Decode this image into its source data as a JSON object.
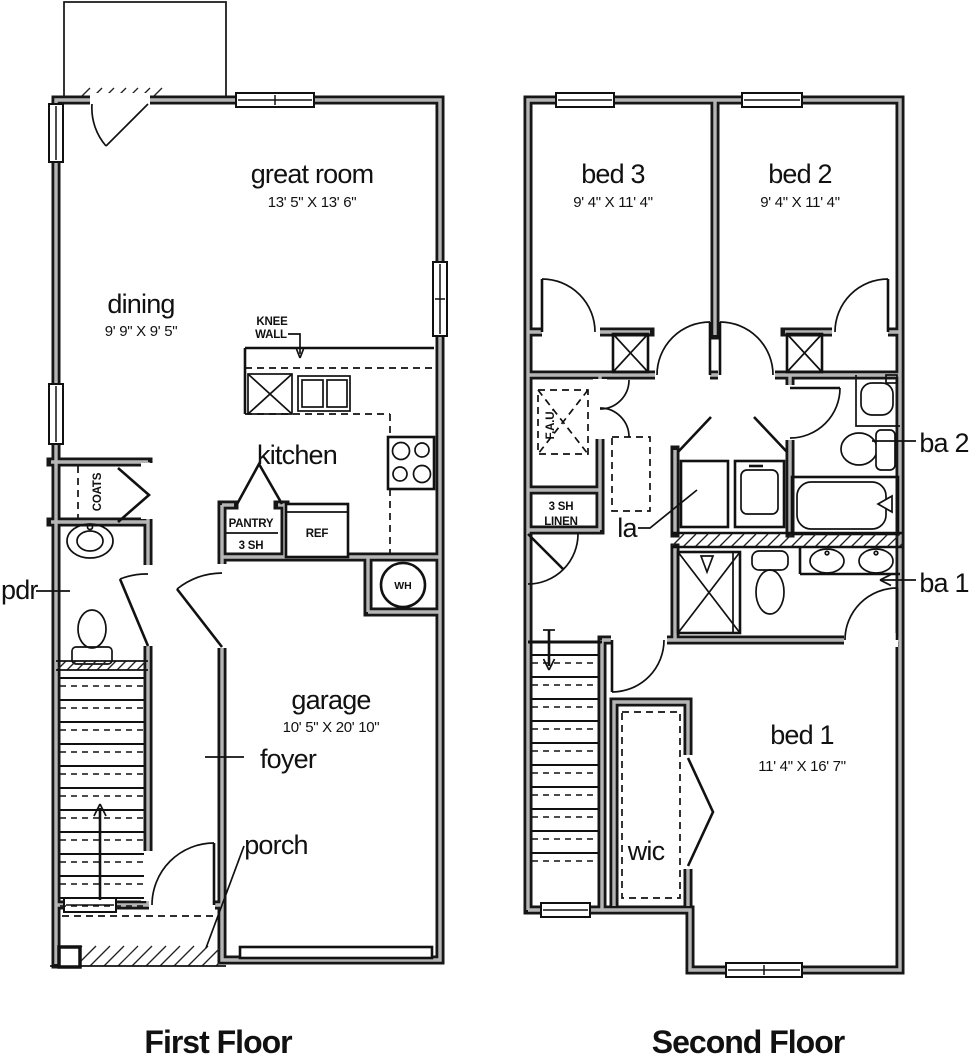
{
  "titles": {
    "first": "First Floor",
    "second": "Second Floor"
  },
  "first_floor": {
    "great_room": {
      "name": "great room",
      "dims": "13' 5\" X 13' 6\""
    },
    "dining": {
      "name": "dining",
      "dims": "9' 9\" X 9' 5\""
    },
    "kitchen": {
      "name": "kitchen"
    },
    "garage": {
      "name": "garage",
      "dims": "10' 5\" X 20' 10\""
    },
    "foyer": {
      "name": "foyer"
    },
    "porch": {
      "name": "porch"
    },
    "pdr": {
      "name": "pdr"
    },
    "coats": {
      "name": "COATS"
    },
    "pantry": {
      "name": "PANTRY",
      "sub": "3 SH"
    },
    "ref": {
      "name": "REF"
    },
    "wh": {
      "name": "WH"
    },
    "knee_wall": {
      "line1": "KNEE",
      "line2": "WALL"
    }
  },
  "second_floor": {
    "bed1": {
      "name": "bed 1",
      "dims": "11' 4\" X 16' 7\""
    },
    "bed2": {
      "name": "bed 2",
      "dims": "9' 4\" X 11' 4\""
    },
    "bed3": {
      "name": "bed 3",
      "dims": "9' 4\" X 11' 4\""
    },
    "ba1": {
      "name": "ba 1"
    },
    "ba2": {
      "name": "ba 2"
    },
    "laundry": {
      "name": "la"
    },
    "wic": {
      "name": "wic"
    },
    "fau": {
      "name": "F.A.U."
    },
    "linen": {
      "line1": "3 SH",
      "line2": "LINEN"
    }
  },
  "colors": {
    "line": "#161616",
    "wall_core": "#b5b5b5",
    "background": "#ffffff"
  }
}
